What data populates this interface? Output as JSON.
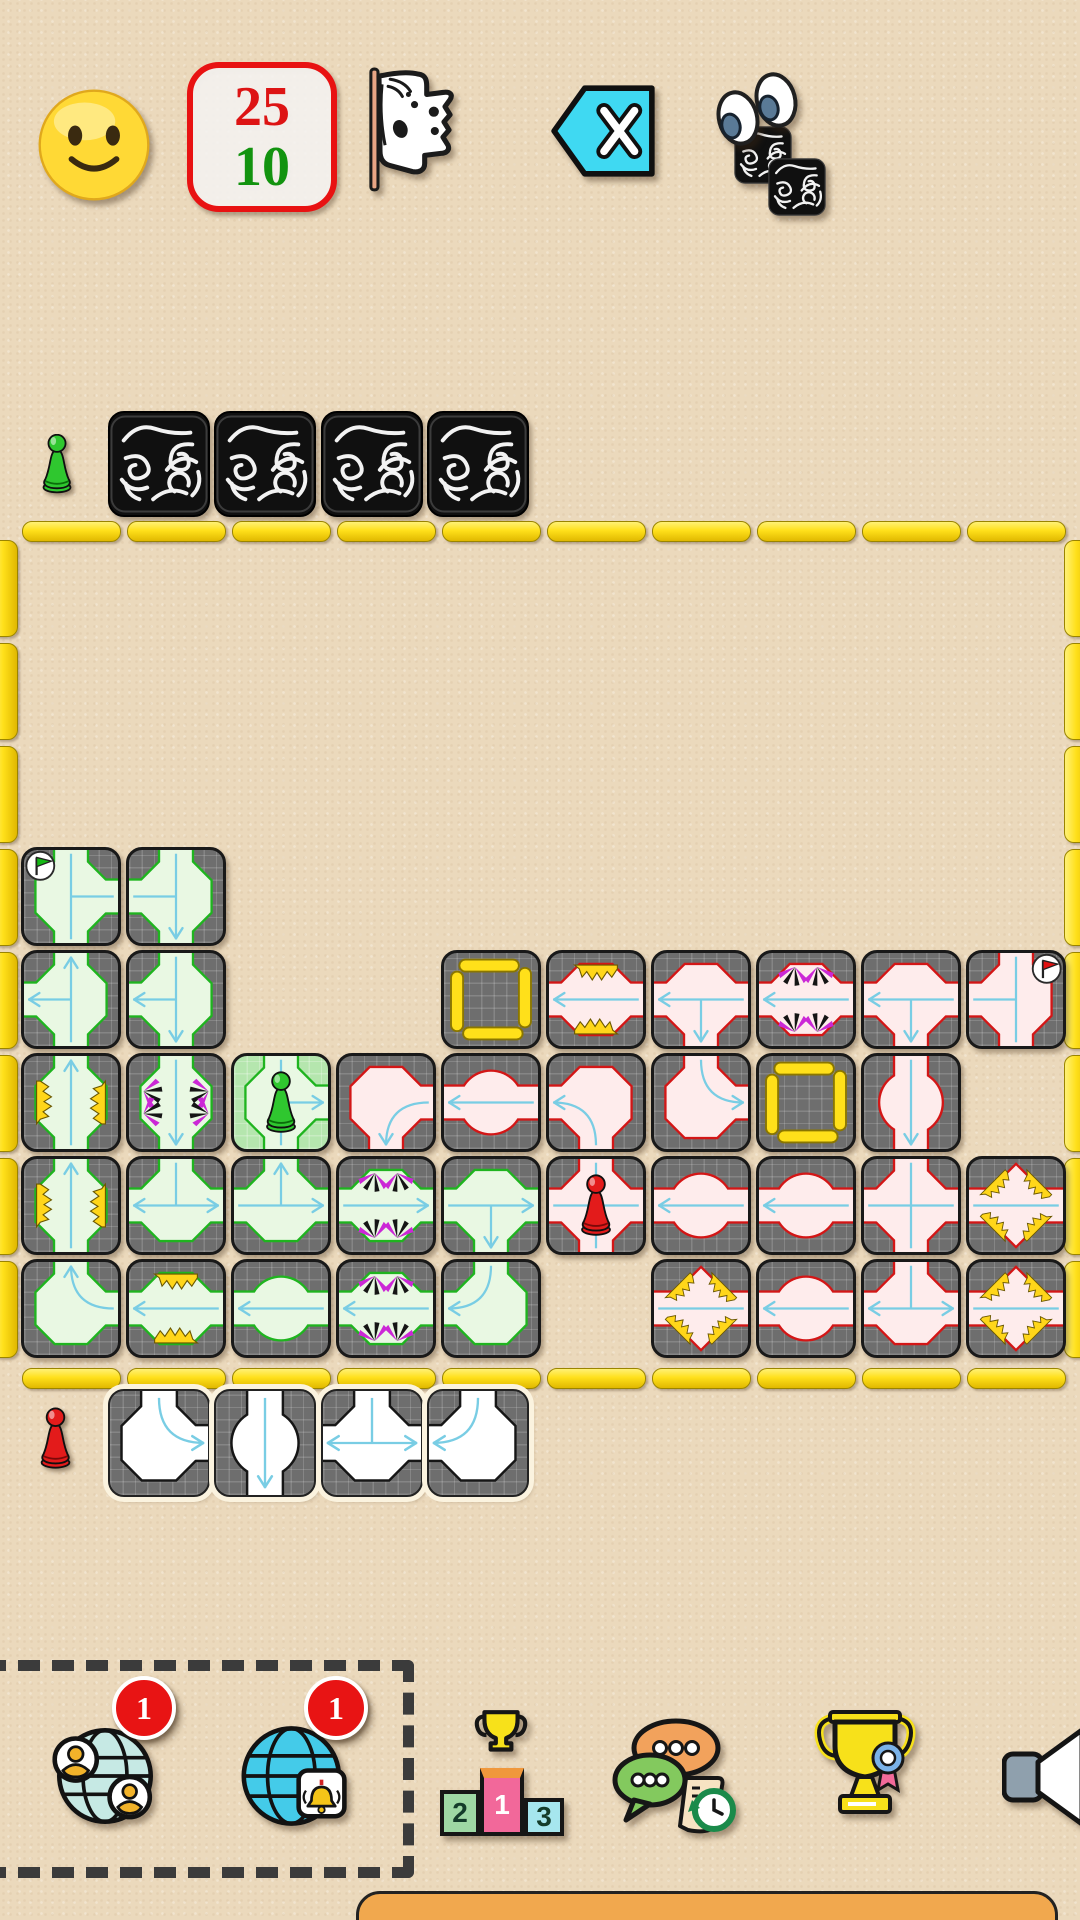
{
  "app": {
    "background": "#ebd9bc"
  },
  "top_bar": {
    "mood_icon": "slightly-smiling-face",
    "score_box": {
      "top_value": "25",
      "bottom_value": "10",
      "top_color": "#dd1414",
      "bottom_color": "#12930f",
      "border_color": "#e81212"
    },
    "surrender_flag_icon": "white-tattered-flag",
    "undo_button_icon": "backspace-x",
    "peek_icon": "eyes-over-facedown-tiles"
  },
  "players": {
    "green": {
      "pawn_color": "#2fc72f",
      "hand_facedown_count": 4
    },
    "red": {
      "pawn_color": "#e31b1b",
      "hand_tiles": [
        {
          "arms": "NE",
          "deco": null,
          "arrows": [
            "E"
          ]
        },
        {
          "arms": "NS",
          "deco": "circle",
          "arrows": [
            "S"
          ]
        },
        {
          "arms": "NWE",
          "deco": null,
          "arrows": [
            "W",
            "E"
          ]
        },
        {
          "arms": "NW",
          "deco": null,
          "arrows": [
            "W"
          ]
        }
      ]
    }
  },
  "board": {
    "cols": 10,
    "rows": 8,
    "border_color": "#ffe01a",
    "tiles": [
      {
        "row": 3,
        "col": 0,
        "color": "green",
        "arms": "NSE",
        "deco": null,
        "arrows": [],
        "badge": "green-flag-tl"
      },
      {
        "row": 3,
        "col": 1,
        "color": "green",
        "arms": "NSW",
        "deco": null,
        "arrows": [
          "S"
        ]
      },
      {
        "row": 4,
        "col": 0,
        "color": "green",
        "arms": "NSW",
        "deco": null,
        "arrows": [
          "N",
          "W"
        ]
      },
      {
        "row": 4,
        "col": 1,
        "color": "green",
        "arms": "NSW",
        "deco": null,
        "arrows": [
          "W",
          "S"
        ]
      },
      {
        "row": 4,
        "col": 4,
        "slot": true
      },
      {
        "row": 4,
        "col": 5,
        "color": "red",
        "arms": "WE",
        "deco": "sparks",
        "arrows": [
          "W"
        ]
      },
      {
        "row": 4,
        "col": 6,
        "color": "red",
        "arms": "WES",
        "deco": null,
        "arrows": [
          "W",
          "S"
        ]
      },
      {
        "row": 4,
        "col": 7,
        "color": "red",
        "arms": "WE",
        "deco": "claws",
        "arrows": [
          "W"
        ]
      },
      {
        "row": 4,
        "col": 8,
        "color": "red",
        "arms": "WES",
        "deco": null,
        "arrows": [
          "W",
          "S"
        ]
      },
      {
        "row": 4,
        "col": 9,
        "color": "red",
        "arms": "NSW",
        "deco": null,
        "arrows": [],
        "badge": "red-flag-tr"
      },
      {
        "row": 5,
        "col": 0,
        "color": "green",
        "arms": "NS",
        "deco": "sparks",
        "arrows": [
          "N"
        ]
      },
      {
        "row": 5,
        "col": 1,
        "color": "green",
        "arms": "NS",
        "deco": "claws",
        "arrows": [
          "S"
        ]
      },
      {
        "row": 5,
        "col": 2,
        "color": "green",
        "arms": "NSE",
        "deco": null,
        "arrows": [
          "E"
        ],
        "pawn": "green",
        "highlight": true
      },
      {
        "row": 5,
        "col": 3,
        "color": "red",
        "arms": "ES",
        "deco": null,
        "arrows": [
          "S"
        ]
      },
      {
        "row": 5,
        "col": 4,
        "color": "red",
        "arms": "WE",
        "deco": "circle",
        "arrows": [
          "W"
        ]
      },
      {
        "row": 5,
        "col": 5,
        "color": "red",
        "arms": "WS",
        "deco": null,
        "arrows": [
          "W"
        ]
      },
      {
        "row": 5,
        "col": 6,
        "color": "red",
        "arms": "NE",
        "deco": null,
        "arrows": [
          "E"
        ]
      },
      {
        "row": 5,
        "col": 7,
        "slot": true
      },
      {
        "row": 5,
        "col": 8,
        "color": "red",
        "arms": "NS",
        "deco": "circle",
        "arrows": [
          "S"
        ]
      },
      {
        "row": 6,
        "col": 0,
        "color": "green",
        "arms": "NS",
        "deco": "sparks",
        "arrows": [
          "N"
        ]
      },
      {
        "row": 6,
        "col": 1,
        "color": "green",
        "arms": "WEN",
        "deco": null,
        "arrows": [
          "W",
          "E"
        ]
      },
      {
        "row": 6,
        "col": 2,
        "color": "green",
        "arms": "WEN",
        "deco": null,
        "arrows": [
          "N",
          "E"
        ]
      },
      {
        "row": 6,
        "col": 3,
        "color": "green",
        "arms": "WE",
        "deco": "claws",
        "arrows": [
          "E"
        ]
      },
      {
        "row": 6,
        "col": 4,
        "color": "green",
        "arms": "WES",
        "deco": null,
        "arrows": [
          "E",
          "S"
        ]
      },
      {
        "row": 6,
        "col": 5,
        "color": "red",
        "arms": "NSWE",
        "deco": null,
        "arrows": [],
        "pawn": "red"
      },
      {
        "row": 6,
        "col": 6,
        "color": "red",
        "arms": "WE",
        "deco": "circle",
        "arrows": [
          "W"
        ]
      },
      {
        "row": 6,
        "col": 7,
        "color": "red",
        "arms": "WE",
        "deco": "circle",
        "arrows": [
          "W"
        ]
      },
      {
        "row": 6,
        "col": 8,
        "color": "red",
        "arms": "NSWE",
        "deco": null,
        "arrows": []
      },
      {
        "row": 6,
        "col": 9,
        "color": "red",
        "arms": "WE",
        "deco": "sparks4",
        "arrows": []
      },
      {
        "row": 7,
        "col": 0,
        "color": "green",
        "arms": "NE",
        "deco": null,
        "arrows": [
          "N"
        ]
      },
      {
        "row": 7,
        "col": 1,
        "color": "green",
        "arms": "WE",
        "deco": "sparks",
        "arrows": [
          "W"
        ]
      },
      {
        "row": 7,
        "col": 2,
        "color": "green",
        "arms": "WE",
        "deco": "circle",
        "arrows": [
          "W"
        ]
      },
      {
        "row": 7,
        "col": 3,
        "color": "green",
        "arms": "WE",
        "deco": "claws",
        "arrows": [
          "W"
        ]
      },
      {
        "row": 7,
        "col": 4,
        "color": "green",
        "arms": "NW",
        "deco": null,
        "arrows": [
          "W"
        ]
      },
      {
        "row": 7,
        "col": 6,
        "color": "red",
        "arms": "WE",
        "deco": "sparks4",
        "arrows": []
      },
      {
        "row": 7,
        "col": 7,
        "color": "red",
        "arms": "WE",
        "deco": "circle",
        "arrows": [
          "W"
        ]
      },
      {
        "row": 7,
        "col": 8,
        "color": "red",
        "arms": "WEN",
        "deco": null,
        "arrows": [
          "W",
          "E"
        ]
      },
      {
        "row": 7,
        "col": 9,
        "color": "red",
        "arms": "WE",
        "deco": "sparks4",
        "arrows": []
      }
    ]
  },
  "toolbar": {
    "buttons": [
      {
        "name": "online-players",
        "icon": "globe-people",
        "badge": "1"
      },
      {
        "name": "online-games",
        "icon": "globe-bell",
        "badge": "1"
      },
      {
        "name": "leaderboard",
        "icon": "podium",
        "podium_labels": {
          "first": "1",
          "second": "2",
          "third": "3"
        }
      },
      {
        "name": "chat-history",
        "icon": "chat-bubbles-clock"
      },
      {
        "name": "achievements",
        "icon": "trophy-rosette"
      },
      {
        "name": "sound",
        "icon": "speaker"
      }
    ]
  },
  "bottom_bar": {
    "color": "#f1a84e"
  }
}
